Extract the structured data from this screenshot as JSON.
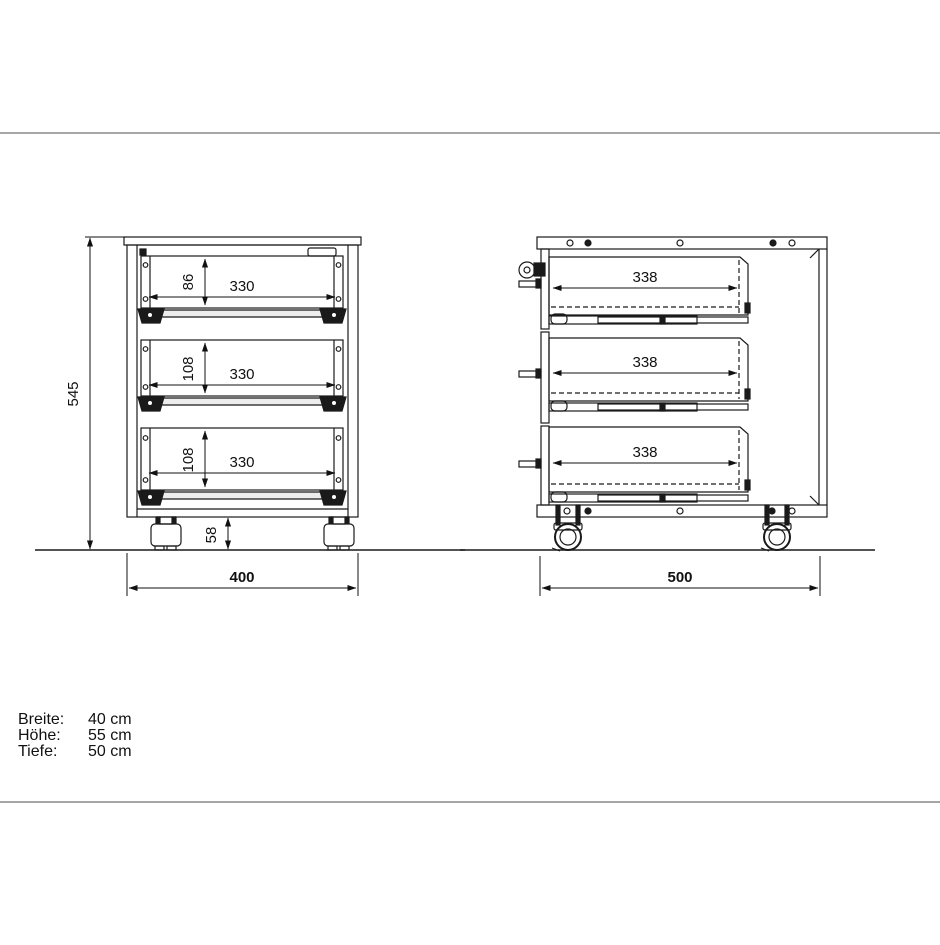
{
  "title": "Rollcontainer Maßzeichnung",
  "front_view": {
    "overall_height_mm": "545",
    "overall_width_mm": "400",
    "caster_height_mm": "58",
    "drawers": [
      {
        "height_mm": "86",
        "width_mm": "330"
      },
      {
        "height_mm": "108",
        "width_mm": "330"
      },
      {
        "height_mm": "108",
        "width_mm": "330"
      }
    ]
  },
  "side_view": {
    "overall_depth_mm": "500",
    "drawers": [
      {
        "depth_mm": "338"
      },
      {
        "depth_mm": "338"
      },
      {
        "depth_mm": "338"
      }
    ]
  },
  "specs": {
    "rows": [
      {
        "label": "Breite:",
        "value": "40 cm"
      },
      {
        "label": "Höhe:",
        "value": "55 cm"
      },
      {
        "label": "Tiefe:",
        "value": "50 cm"
      }
    ]
  },
  "colors": {
    "line": "#1a1a1a",
    "separator": "#a6a6a6",
    "background": "#ffffff"
  }
}
